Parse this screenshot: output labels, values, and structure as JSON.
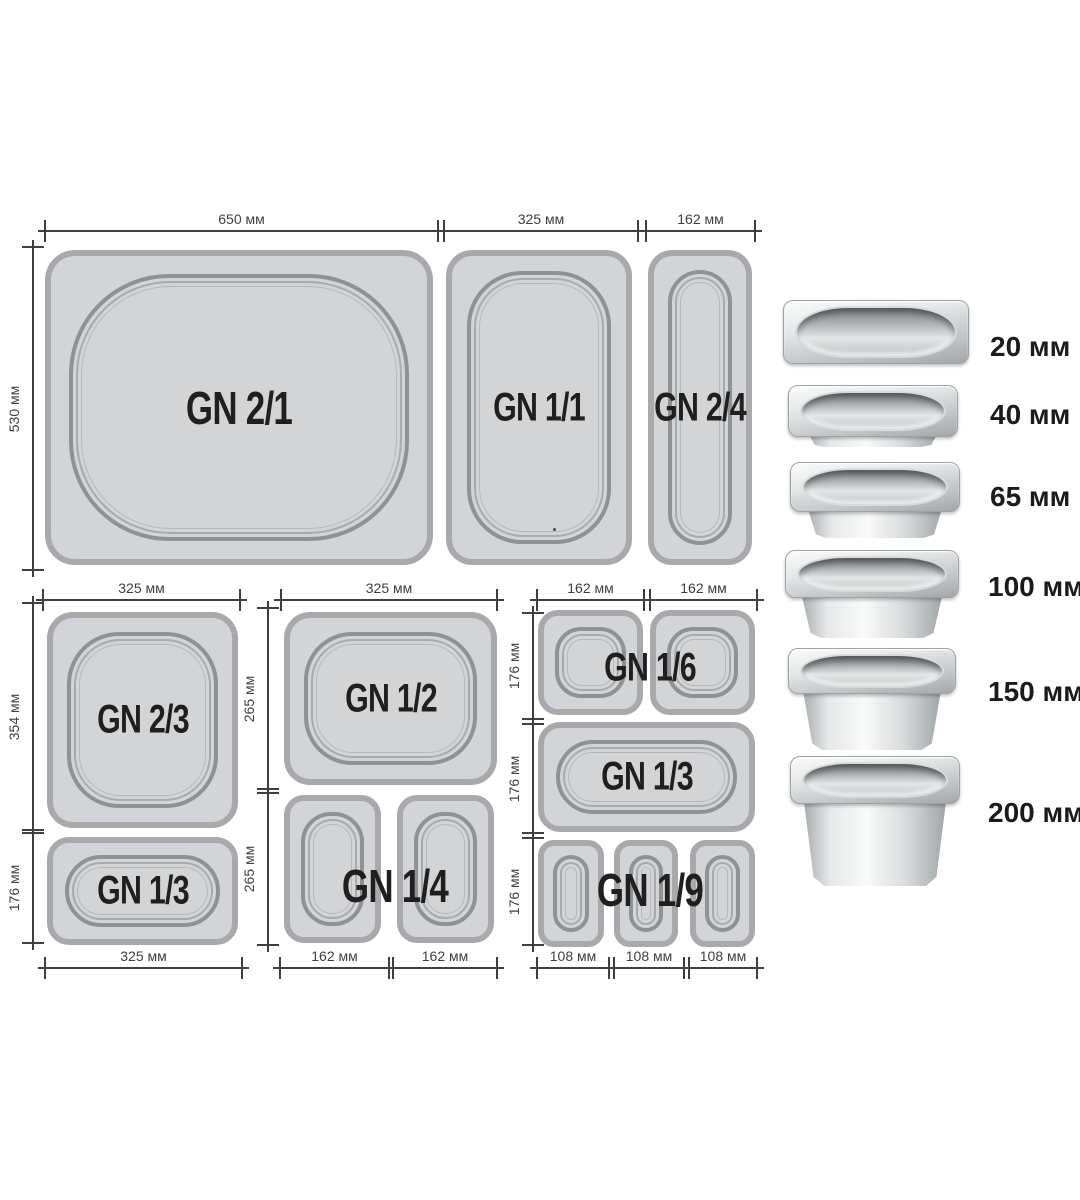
{
  "pans": {
    "gn21": "GN 2/1",
    "gn11": "GN 1/1",
    "gn24": "GN 2/4",
    "gn23": "GN 2/3",
    "gn13_left": "GN 1/3",
    "gn12": "GN 1/2",
    "gn14": "GN 1/4",
    "gn16": "GN 1/6",
    "gn13_right": "GN 1/3",
    "gn19": "GN 1/9"
  },
  "dims": {
    "w650": "650 мм",
    "w325": "325 мм",
    "w162": "162 мм",
    "w108": "108 мм",
    "h530": "530 мм",
    "h354": "354 мм",
    "h265": "265 мм",
    "h176": "176 мм"
  },
  "depths": [
    {
      "label": "20 мм"
    },
    {
      "label": "40 мм"
    },
    {
      "label": "65 мм"
    },
    {
      "label": "100 мм"
    },
    {
      "label": "150 мм"
    },
    {
      "label": "200 мм"
    }
  ],
  "colors": {
    "background": "#ffffff",
    "pan_fill": "#d3d4d6",
    "pan_border": "#a7a9ac",
    "rim_line": "#8f9295",
    "dim_line": "#3f3f3f",
    "gn_text": "#1f1f1f",
    "depth_text": "#1b1b1b"
  }
}
